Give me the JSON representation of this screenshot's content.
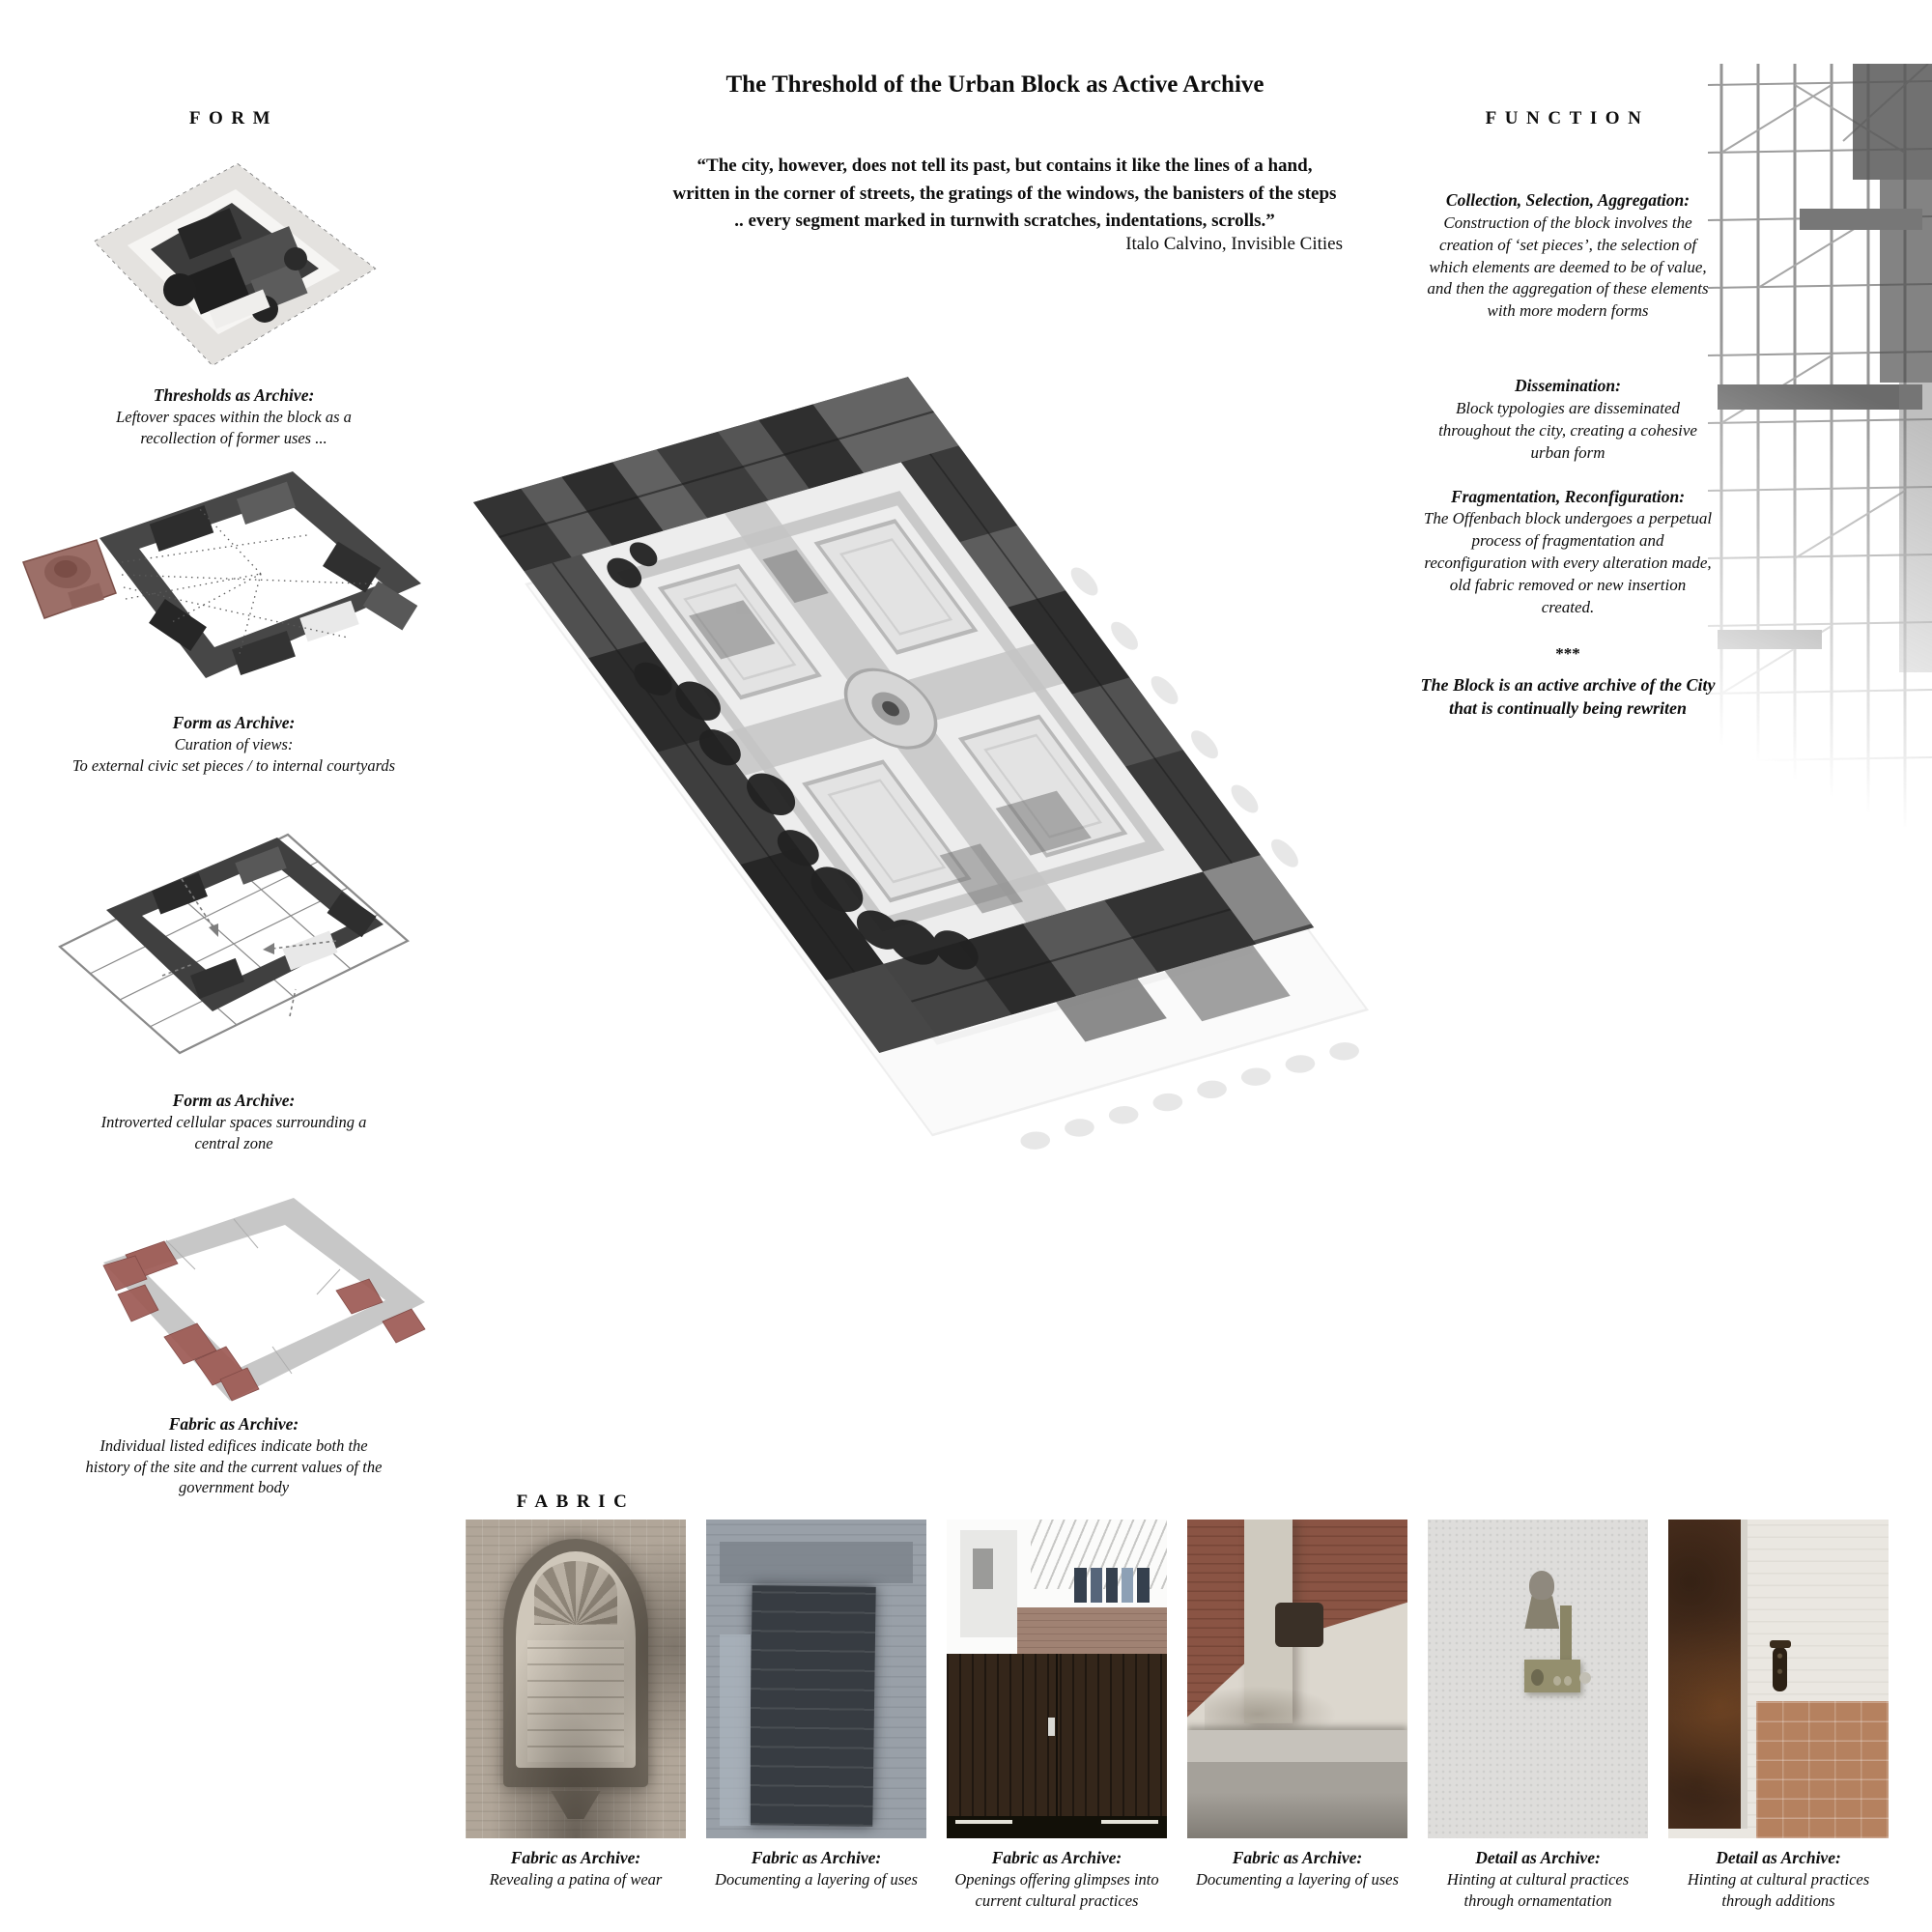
{
  "page": {
    "title": "The Threshold of the Urban Block as Active Archive"
  },
  "quote": {
    "text": "“The city, however, does not tell its past, but contains it like the lines of a hand,\nwritten in the corner of streets, the gratings of the windows, the banisters of the steps\n.. every segment marked in turnwith scratches, indentations, scrolls.”",
    "attribution": "Italo Calvino, Invisible Cities"
  },
  "form": {
    "heading": "FORM",
    "items": [
      {
        "title": "Thresholds as Archive:",
        "body": "Leftover spaces within the block as a\nrecollection of former uses ..."
      },
      {
        "title": "Form as Archive:",
        "body": "Curation of views:\nTo external civic set pieces   /   to internal courtyards"
      },
      {
        "title": "Form as Archive:",
        "body": "Introverted cellular spaces surrounding a\ncentral zone"
      },
      {
        "title": "Fabric as Archive:",
        "body": "Individual listed edifices indicate both the\nhistory of the site and the current values of the\ngovernment body"
      }
    ]
  },
  "function": {
    "heading": "FUNCTION",
    "blocks": [
      {
        "title": "Collection, Selection, Aggregation:",
        "body": "Construction of the block involves the\ncreation of ‘set pieces’, the selection of\nwhich elements are deemed to be of value,\nand then the aggregation of these elements\nwith more modern forms"
      },
      {
        "title": "Dissemination:",
        "body": "Block typologies are disseminated\nthroughout the city, creating a cohesive\nurban form"
      },
      {
        "title": "Fragmentation, Reconfiguration:",
        "body": "The Offenbach block undergoes a perpetual\nprocess of fragmentation and\nreconfiguration with every alteration made,\nold fabric removed or new insertion\ncreated."
      }
    ],
    "separator": "***",
    "conclusion": "The Block is an active archive of the City\nthat is continually being rewriten"
  },
  "fabric": {
    "heading": "FABRIC",
    "photos": [
      {
        "caption_title": "Fabric as Archive:",
        "caption_body": "Revealing a patina of wear"
      },
      {
        "caption_title": "Fabric as Archive:",
        "caption_body": "Documenting a layering of uses"
      },
      {
        "caption_title": "Fabric as Archive:",
        "caption_body": "Openings offering glimpses into\ncurrent cultural practices"
      },
      {
        "caption_title": "Fabric as Archive:",
        "caption_body": "Documenting a layering of uses"
      },
      {
        "caption_title": "Detail as Archive:",
        "caption_body": "Hinting at cultural practices\nthrough ornamentation"
      },
      {
        "caption_title": "Detail as Archive:",
        "caption_body": "Hinting at cultural practices\nthrough additions"
      }
    ]
  },
  "colors": {
    "accent_red_church": "#9c6f68",
    "accent_red_listed": "#9d5a54",
    "building_dark": "#474747",
    "ghost_grey": "#e9e9e9"
  }
}
